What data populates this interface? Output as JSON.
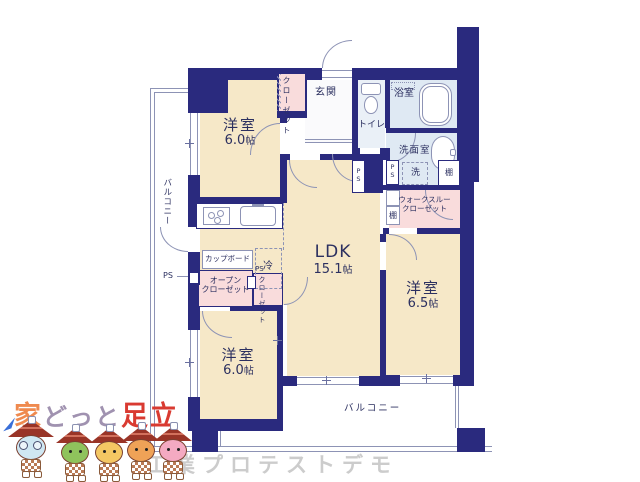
{
  "colors": {
    "wall": "#2a2a7e",
    "room": "#f6e8c8",
    "closet": "#f9dcdc",
    "wet": "#dfe9f3",
    "wet2": "#eaf0f7",
    "line": "#8d93b5",
    "text": "#2c3060",
    "roof": "#993427"
  },
  "rooms": {
    "bedroom1": {
      "label": "洋室",
      "size": "6.0",
      "unit": "帖"
    },
    "bedroom2": {
      "label": "洋室",
      "size": "6.5",
      "unit": "帖"
    },
    "bedroom3": {
      "label": "洋室",
      "size": "6.0",
      "unit": "帖"
    },
    "ldk": {
      "label": "LDK",
      "size": "15.1",
      "unit": "帖"
    }
  },
  "labels": {
    "entrance": "玄関",
    "toilet": "トイレ",
    "bathroom": "浴室",
    "washroom": "洗面室",
    "washer": "洗",
    "shelf": "棚",
    "ps": "PS",
    "closet": "クローゼット",
    "walkthrough_closet_1": "ウォークスルー",
    "walkthrough_closet_2": "クローゼット",
    "open_closet_1": "オープン",
    "open_closet_2": "クローゼット",
    "cupboard": "カップボード",
    "fridge": "冷",
    "balcony": "バルコニー"
  },
  "logo": {
    "parts": [
      {
        "text": "家",
        "color": "#ef8a4f"
      },
      {
        "text": "どっと",
        "color": "#a092b0"
      },
      {
        "text": "足立",
        "color": "#d93a31"
      }
    ]
  },
  "watermark": {
    "text": "工業プロテストデモ",
    "color": "#cccccc"
  },
  "mascots": [
    {
      "face": "#cfe7f2"
    },
    {
      "face": "#8fc35c"
    },
    {
      "face": "#f4c763"
    },
    {
      "face": "#efa257"
    },
    {
      "face": "#f4aac2"
    }
  ]
}
